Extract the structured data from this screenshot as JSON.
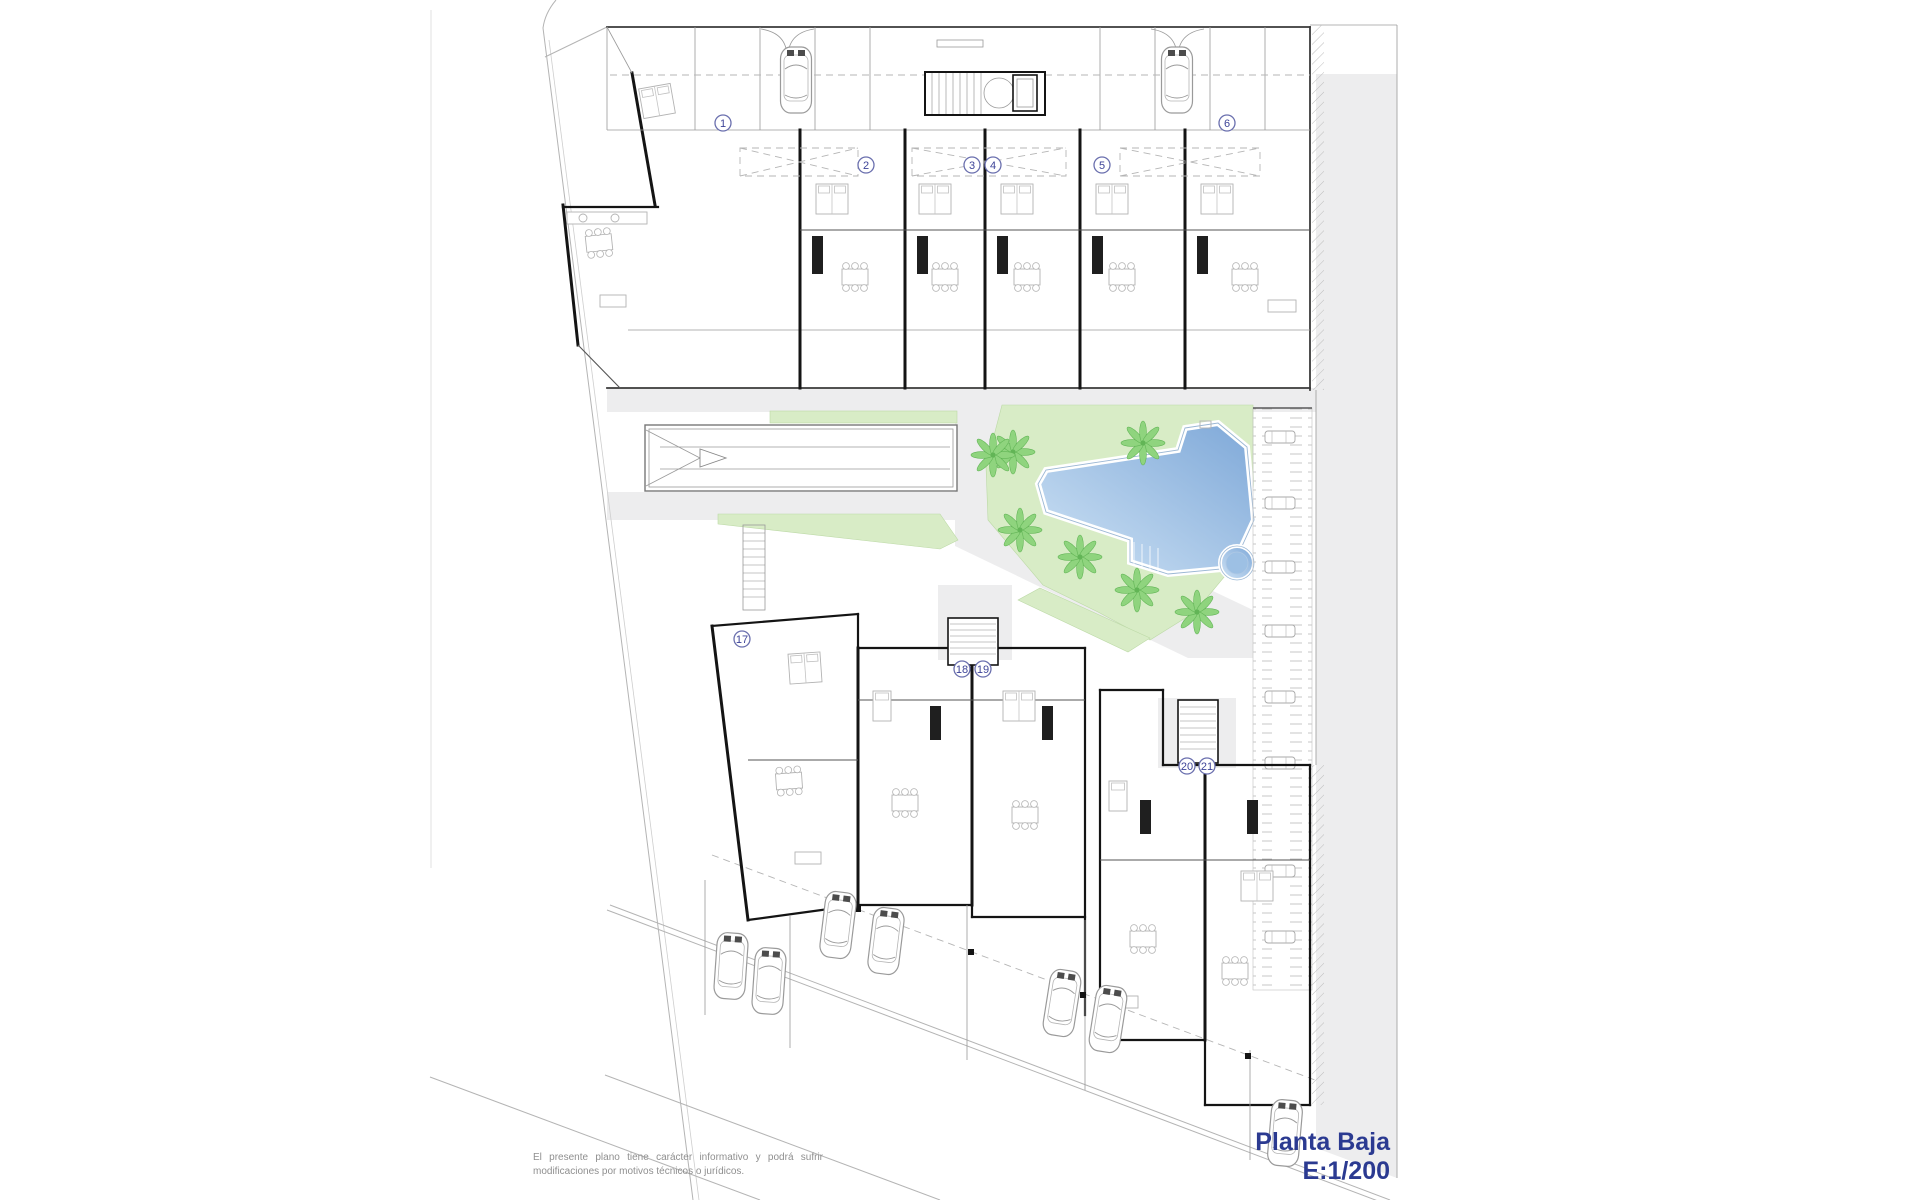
{
  "title": {
    "line1": "Planta Baja",
    "line2": "E:1/200"
  },
  "disclaimer": "El presente plano tiene carácter informativo y podrá sufrir modificaciones por motivos técnicos o jurídicos.",
  "units": [
    {
      "number": "1"
    },
    {
      "number": "2"
    },
    {
      "number": "3"
    },
    {
      "number": "4"
    },
    {
      "number": "5"
    },
    {
      "number": "6"
    },
    {
      "number": "17"
    },
    {
      "number": "18"
    },
    {
      "number": "19"
    },
    {
      "number": "20"
    },
    {
      "number": "21"
    }
  ],
  "colors": {
    "title_text": "#2b3a91",
    "marker_blue": "#3d4398",
    "disclaimer_gray": "#8f8f8f",
    "lawn_green": "#d8ecc6",
    "palm_green": "#8fd47e",
    "pool_light": "#cfe3f5",
    "pool_dark": "#7ea8d8",
    "path_gray": "#ededee",
    "wall_dark": "#141414"
  }
}
